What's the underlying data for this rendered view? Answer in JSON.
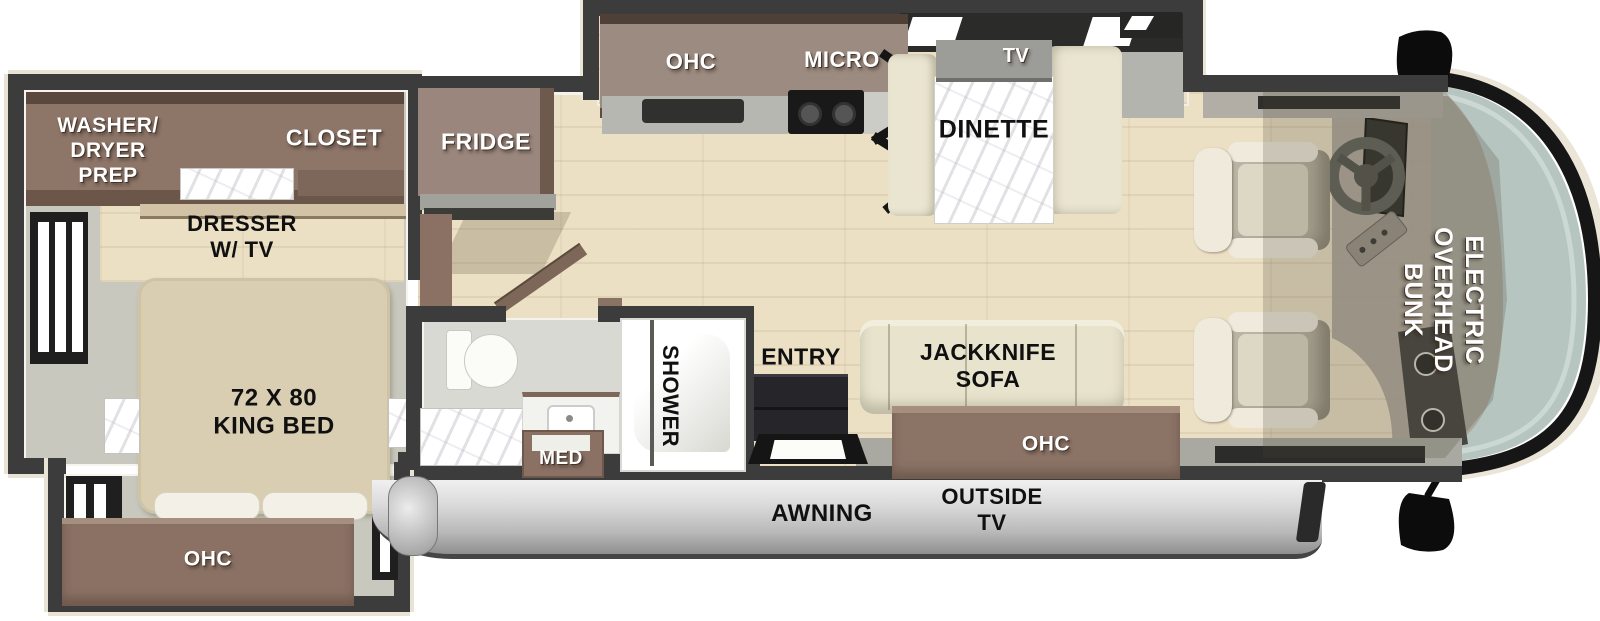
{
  "labels": {
    "washer_dryer_prep": "WASHER/\nDRYER\nPREP",
    "closet": "CLOSET",
    "dresser_tv": "DRESSER\nW/ TV",
    "king_bed": "72 X 80\nKING BED",
    "bedroom_ohc": "OHC",
    "fridge": "FRIDGE",
    "kitchen_ohc": "OHC",
    "micro": "MICRO",
    "tv": "TV",
    "dinette": "DINETTE",
    "med": "MED",
    "shower": "SHOWER",
    "entry": "ENTRY",
    "jackknife_sofa": "JACKKNIFE\nSOFA",
    "living_ohc": "OHC",
    "awning": "AWNING",
    "outside_tv": "OUTSIDE\nTV",
    "overhead_bunk": "ELECTRIC\nOVERHEAD\nBUNK"
  },
  "colors": {
    "wall": "#3c3c3c",
    "cabinet": "#8d7568",
    "cabinet_dark": "#5e4c41",
    "wood_floor": "#ebdfc4",
    "gray_floor": "#c8c8be",
    "cushion": "#e8e3cd",
    "bed": "#d9ceb2",
    "windshield_glass": "#b6c5c0",
    "awning_light": "#f0f0f0",
    "awning_dark": "#8f8f8f",
    "entry_steps": "#26262a"
  }
}
